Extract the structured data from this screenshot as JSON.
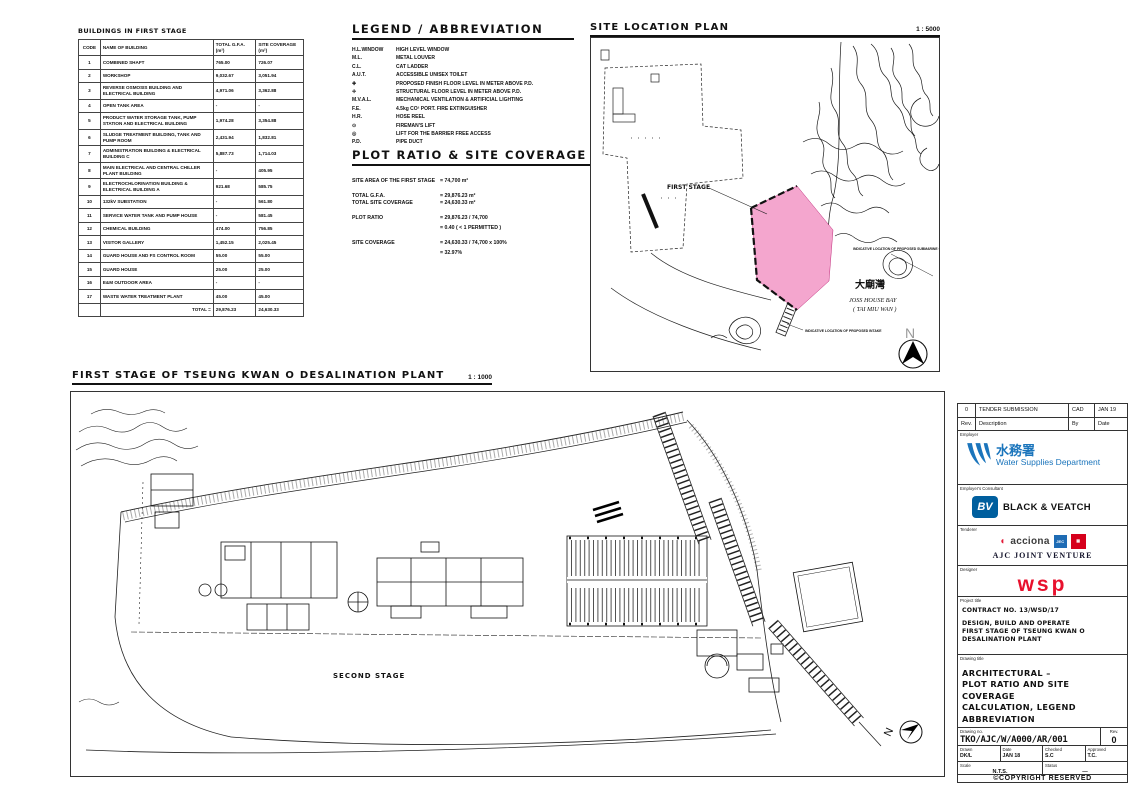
{
  "buildings_table": {
    "title": "BUILDINGS IN FIRST STAGE",
    "headers": {
      "code": "CODE",
      "name": "NAME OF BUILDING",
      "gfa": "TOTAL G.F.A. (m²)",
      "coverage": "SITE COVERAGE (m²)"
    },
    "rows": [
      {
        "code": "1",
        "name": "COMBINED SHAFT",
        "gfa": "765.00",
        "coverage": "726.07"
      },
      {
        "code": "2",
        "name": "WORKSHOP",
        "gfa": "9,032.67",
        "coverage": "3,051.94"
      },
      {
        "code": "3",
        "name": "REVERSE OSMOSIS BUILDING AND ELECTRICAL BUILDING",
        "gfa": "4,971.06",
        "coverage": "3,362.88"
      },
      {
        "code": "4",
        "name": "OPEN TANK AREA",
        "gfa": "-",
        "coverage": "-"
      },
      {
        "code": "5",
        "name": "PRODUCT WATER STORAGE TANK, PUMP STATION AND ELECTRICAL BUILDING",
        "gfa": "1,974.28",
        "coverage": "3,354.88"
      },
      {
        "code": "6",
        "name": "SLUDGE TREATMENT BUILDING, TANK AND PUMP ROOM",
        "gfa": "2,431.94",
        "coverage": "1,832.81"
      },
      {
        "code": "7",
        "name": "ADMINISTRATION BUILDING & ELECTRICAL BUILDING C",
        "gfa": "5,887.73",
        "coverage": "1,714.03"
      },
      {
        "code": "8",
        "name": "MAIN ELECTRICAL AND CENTRAL CHILLER PLANT BUILDING",
        "gfa": "-",
        "coverage": "405.95"
      },
      {
        "code": "9",
        "name": "ELECTROCHLORINATION BUILDING & ELECTRICAL BUILDING A",
        "gfa": "921.68",
        "coverage": "585.75"
      },
      {
        "code": "10",
        "name": "132kV SUBSTATION",
        "gfa": "-",
        "coverage": "561.80"
      },
      {
        "code": "11",
        "name": "SERVICE WATER TANK AND PUMP HOUSE",
        "gfa": "-",
        "coverage": "581.45"
      },
      {
        "code": "12",
        "name": "CHEMICAL BUILDING",
        "gfa": "474.00",
        "coverage": "756.85"
      },
      {
        "code": "13",
        "name": "VISITOR GALLERY",
        "gfa": "1,452.15",
        "coverage": "2,025.45"
      },
      {
        "code": "14",
        "name": "GUARD HOUSE AND FS CONTROL ROOM",
        "gfa": "55.00",
        "coverage": "55.00"
      },
      {
        "code": "15",
        "name": "GUARD HOUSE",
        "gfa": "25.00",
        "coverage": "25.00"
      },
      {
        "code": "16",
        "name": "E&M OUTDOOR AREA",
        "gfa": "-",
        "coverage": "-"
      },
      {
        "code": "17",
        "name": "WASTE WATER TREATMENT PLANT",
        "gfa": "45.00",
        "coverage": "45.00"
      }
    ],
    "total_label": "TOTAL =",
    "total_gfa": "29,876.23",
    "total_coverage": "24,630.33"
  },
  "legend": {
    "title": "LEGEND / ABBREVIATION",
    "items": [
      {
        "sym": "H.L.WINDOW",
        "desc": "HIGH LEVEL WINDOW"
      },
      {
        "sym": "M.L.",
        "desc": "METAL LOUVER"
      },
      {
        "sym": "C.L.",
        "desc": "CAT LADDER"
      },
      {
        "sym": "A.U.T.",
        "desc": "ACCESSIBLE UNISEX TOILET"
      },
      {
        "sym": "✚",
        "desc": "PROPOSED FINISH FLOOR LEVEL IN METER ABOVE P.D."
      },
      {
        "sym": "✛",
        "desc": "STRUCTURAL FLOOR LEVEL IN METER ABOVE P.D."
      },
      {
        "sym": "M.V.A.L.",
        "desc": "MECHANICAL VENTILATION & ARTIFICIAL LIGHTING"
      },
      {
        "sym": "F.E.",
        "desc": "4.5kg CO² PORT. FIRE EXTINGUISHER"
      },
      {
        "sym": "H.R.",
        "desc": "HOSE REEL"
      },
      {
        "sym": "⊙",
        "desc": "FIREMAN'S LIFT"
      },
      {
        "sym": "◎",
        "desc": "LIFT FOR THE BARRIER FREE ACCESS"
      },
      {
        "sym": "P.D.",
        "desc": "PIPE DUCT"
      }
    ]
  },
  "plot_ratio": {
    "title": "PLOT RATIO & SITE COVERAGE CALCULATION:",
    "l1": {
      "label": "SITE AREA OF THE FIRST STAGE",
      "value": "=  74,700 m²"
    },
    "l2": {
      "label": "TOTAL G.F.A.",
      "value": "=  29,876.23 m²"
    },
    "l3": {
      "label": "TOTAL SITE COVERAGE",
      "value": "=  24,630.33 m²"
    },
    "l4": {
      "label": "PLOT RATIO",
      "value": "=  29,876.23 / 74,700"
    },
    "l5": {
      "label": "",
      "value": "=  0.40  ( < 1 PERMITTED )"
    },
    "l6": {
      "label": "SITE COVERAGE",
      "value": "=  24,630.33 / 74,700 x 100%"
    },
    "l7": {
      "label": "",
      "value": "=  32.97%"
    }
  },
  "site_plan": {
    "title": "SITE LOCATION PLAN",
    "scale": "1 : 5000",
    "first_stage_label": "FIRST STAGE",
    "bay_cjk": "大廟灣",
    "bay_name": "JOSS HOUSE BAY",
    "bay_name2": "( TAI MIU WAN )",
    "north_label": "N",
    "note_outfall": "INDICATIVE LOCATION OF PROPOSED SUBMARINE OUTFALL",
    "note_intake": "INDICATIVE LOCATION OF PROPOSED INTAKE"
  },
  "main_plan": {
    "title": "FIRST STAGE OF TSEUNG KWAN O DESALINATION PLANT",
    "scale": "1 : 1000",
    "second_stage": "SECOND STAGE",
    "north_label": "N"
  },
  "title_block": {
    "revision": {
      "rev": "0",
      "description": "TENDER SUBMISSION",
      "by": "CAD",
      "date": "JAN 19",
      "rev_label": "Rev.",
      "description_label": "Description",
      "by_label": "By",
      "date_label": "Date"
    },
    "employer_label": "Employer",
    "employer_cjk": "水務署",
    "employer_name": "Water Supplies Department",
    "consultant_label": "Employer's Consultant",
    "consultant_monogram": "BV",
    "consultant_name": "BLACK & VEATCH",
    "tenderer_label": "Tenderer",
    "acciona": "acciona",
    "jec": "JEC",
    "tenderer_name": "AJC JOINT VENTURE",
    "designer_label": "Designer",
    "designer_name": "wsp",
    "project_label": "Project title",
    "contract": "CONTRACT NO. 13/WSD/17",
    "project_lines": "DESIGN, BUILD AND OPERATE\nFIRST STAGE OF TSEUNG KWAN O\nDESALINATION PLANT",
    "drawing_title_label": "Drawing title",
    "drawing_title_lines": "ARCHITECTURAL –\nPLOT RATIO AND SITE COVERAGE\nCALCULATION, LEGEND\nABBREVIATION",
    "drawing_no_label": "Drawing no.",
    "drawing_no": "TKO/AJC/W/A000/AR/001",
    "rev_box_label": "Rev.",
    "rev_no": "0",
    "drawn_label": "Drawn",
    "drawn": "DK/L",
    "date_label": "Date",
    "date": "JAN 18",
    "checked_label": "Checked",
    "checked": "S.C",
    "approved_label": "Approved",
    "approved": "T.C.",
    "scale_label": "Scale",
    "scale": "N.T.S.",
    "status_label": "Status",
    "status": "—",
    "copyright": "©COPYRIGHT RESERVED"
  },
  "colors": {
    "first_stage_pink": "#f4a6ce",
    "wsd_blue": "#1b75bc",
    "bv_blue": "#005f9e",
    "acciona_red": "#e31937",
    "jec_blue": "#1f6cb4",
    "csc_red": "#d6001c",
    "wsp_red": "#e8112d",
    "line_color": "#222222"
  }
}
